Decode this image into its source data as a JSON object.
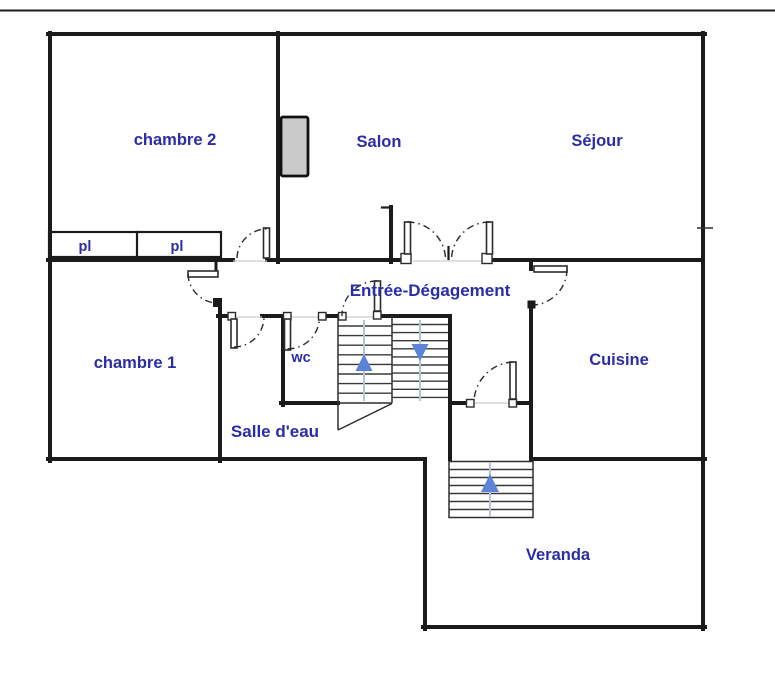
{
  "colors": {
    "background": "#ffffff",
    "wall": "#1b1b1b",
    "room_label": "#2b2da6",
    "stair_arrow": "#5b83d8",
    "stair_centerline": "#b7c1dc",
    "chimney_fill": "#cacaca"
  },
  "rooms": {
    "chambre2": {
      "label": "chambre 2"
    },
    "salon": {
      "label": "Salon"
    },
    "sejour": {
      "label": "Séjour"
    },
    "closet1": {
      "label": "pl"
    },
    "closet2": {
      "label": "pl"
    },
    "entree": {
      "label": "Entrée-Dégagement"
    },
    "chambre1": {
      "label": "chambre 1"
    },
    "wc": {
      "label": "wc"
    },
    "salle_deau": {
      "label": "Salle d'eau"
    },
    "cuisine": {
      "label": "Cuisine"
    },
    "veranda": {
      "label": "Veranda"
    }
  },
  "stairs": {
    "main_staircase": {
      "left_flight_direction": "up",
      "right_flight_direction": "down",
      "left_treads": 9,
      "right_treads": 10
    },
    "veranda_steps": {
      "direction": "up",
      "treads": 7
    }
  }
}
